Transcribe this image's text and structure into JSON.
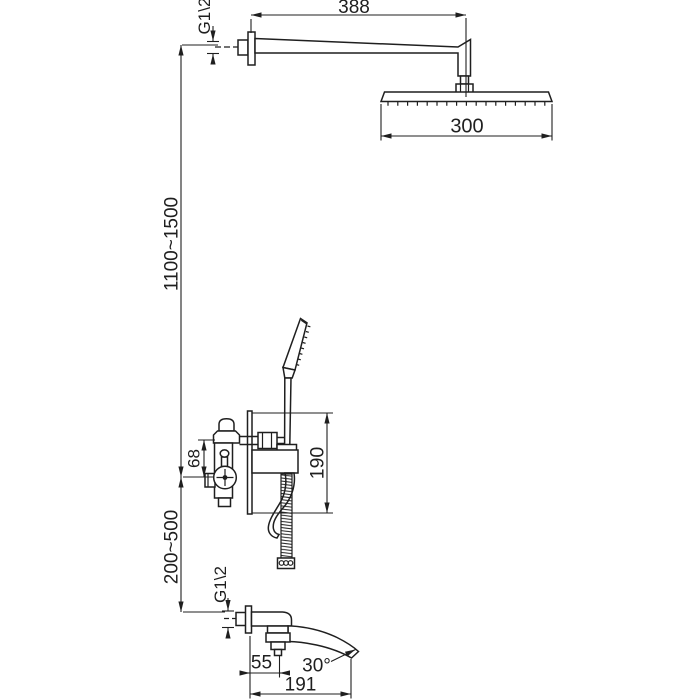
{
  "drawing": {
    "type": "technical-installation-diagram",
    "subject": "wall-mounted shower system with rain head, hand shower mixer valve and tub spout",
    "ink_color": "#1f1f1f",
    "background_color": "#ffffff"
  },
  "labels": {
    "arm_length": "388",
    "top_thread": "G1\\2",
    "head_width": "300",
    "mount_height": "1100~1500",
    "port_offset": "68",
    "trim_height": "190",
    "spout_drop": "200~500",
    "bottom_thread": "G1\\2",
    "spout_offset": "55",
    "spout_angle": "30°",
    "spout_length": "191"
  }
}
